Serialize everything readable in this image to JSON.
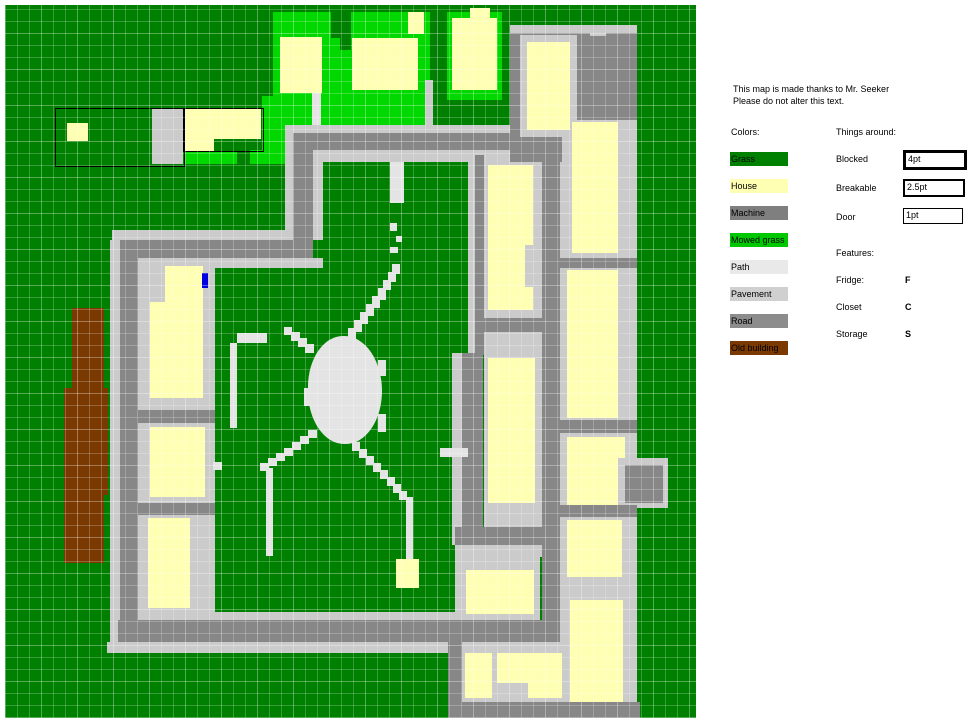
{
  "legend": {
    "credit_line1": "This map is made thanks to Mr. Seeker",
    "credit_line2": "Please do not alter this text.",
    "colors_title": "Colors:",
    "swatches": [
      {
        "label": "Grass",
        "color": "#008000"
      },
      {
        "label": "House",
        "color": "#FFFFB4"
      },
      {
        "label": "Machine",
        "color": "#7F7F7F"
      },
      {
        "label": "Mowed grass",
        "color": "#00C800"
      },
      {
        "label": "Path",
        "color": "#E9E9E9"
      },
      {
        "label": "Pavement",
        "color": "#D0D0D0"
      },
      {
        "label": "Road",
        "color": "#8C8C8C"
      },
      {
        "label": "Old building",
        "color": "#7A3900"
      }
    ],
    "things_title": "Things around:",
    "things": [
      {
        "label": "Blocked",
        "value": "4pt",
        "border_px": 3
      },
      {
        "label": "Breakable",
        "value": "2.5pt",
        "border_px": 2
      },
      {
        "label": "Door",
        "value": "1pt",
        "border_px": 1
      }
    ],
    "features_title": "Features:",
    "features": [
      {
        "label": "Fridge:",
        "value": "F"
      },
      {
        "label": "Closet",
        "value": "C"
      },
      {
        "label": "Storage",
        "value": "S"
      }
    ]
  },
  "map": {
    "bounds": {
      "x": 5,
      "y": 5,
      "w": 691,
      "h": 713
    },
    "palette": {
      "grass": "#008000",
      "mowed": "#00D800",
      "house": "#FFFFB4",
      "path": "#E4E4E4",
      "pavement": "#CBCBCB",
      "road": "#878787",
      "old": "#7A3900",
      "door": "#0000E0"
    },
    "rect_format": "[x, y, w, h, colorKey]",
    "rects": [
      [
        5,
        5,
        691,
        713,
        "grass"
      ],
      [
        273,
        12,
        157,
        113,
        "mowed"
      ],
      [
        331,
        12,
        20,
        26,
        "grass"
      ],
      [
        340,
        26,
        11,
        24,
        "grass"
      ],
      [
        447,
        12,
        55,
        88,
        "mowed"
      ],
      [
        280,
        37,
        42,
        56,
        "house"
      ],
      [
        352,
        38,
        66,
        52,
        "house"
      ],
      [
        408,
        12,
        16,
        22,
        "house"
      ],
      [
        470,
        8,
        20,
        10,
        "house"
      ],
      [
        452,
        18,
        45,
        72,
        "house"
      ],
      [
        312,
        93,
        9,
        41,
        "path"
      ],
      [
        425,
        80,
        8,
        53,
        "pavement"
      ],
      [
        152,
        108,
        31,
        56,
        "pavement"
      ],
      [
        67,
        123,
        21,
        18,
        "house"
      ],
      [
        184,
        109,
        77,
        30,
        "house"
      ],
      [
        185,
        139,
        29,
        12,
        "house"
      ],
      [
        262,
        96,
        24,
        68,
        "mowed"
      ],
      [
        250,
        150,
        12,
        14,
        "mowed"
      ],
      [
        185,
        151,
        52,
        13,
        "mowed"
      ],
      [
        285,
        125,
        226,
        8,
        "pavement"
      ],
      [
        313,
        150,
        198,
        12,
        "pavement"
      ],
      [
        285,
        133,
        226,
        17,
        "road"
      ],
      [
        285,
        125,
        8,
        115,
        "pavement"
      ],
      [
        313,
        162,
        10,
        78,
        "pavement"
      ],
      [
        293,
        150,
        20,
        92,
        "road"
      ],
      [
        112,
        230,
        181,
        10,
        "pavement"
      ],
      [
        138,
        258,
        185,
        10,
        "pavement"
      ],
      [
        120,
        240,
        193,
        18,
        "road"
      ],
      [
        110,
        240,
        10,
        402,
        "pavement"
      ],
      [
        138,
        268,
        10,
        344,
        "pavement"
      ],
      [
        120,
        258,
        18,
        362,
        "road"
      ],
      [
        138,
        612,
        317,
        8,
        "pavement"
      ],
      [
        107,
        642,
        358,
        11,
        "pavement"
      ],
      [
        118,
        620,
        337,
        22,
        "road"
      ],
      [
        148,
        258,
        67,
        354,
        "pavement"
      ],
      [
        135,
        410,
        80,
        13,
        "road"
      ],
      [
        135,
        503,
        80,
        12,
        "road"
      ],
      [
        165,
        266,
        38,
        36,
        "house"
      ],
      [
        150,
        302,
        53,
        96,
        "house"
      ],
      [
        150,
        427,
        55,
        70,
        "house"
      ],
      [
        148,
        518,
        42,
        90,
        "house"
      ],
      [
        202,
        273,
        6,
        15,
        "door"
      ],
      [
        72,
        308,
        32,
        80,
        "old"
      ],
      [
        64,
        388,
        44,
        107,
        "old"
      ],
      [
        64,
        495,
        40,
        68,
        "old"
      ],
      [
        468,
        155,
        7,
        198,
        "pavement"
      ],
      [
        475,
        155,
        9,
        200,
        "road"
      ],
      [
        452,
        353,
        10,
        192,
        "pavement"
      ],
      [
        462,
        353,
        21,
        192,
        "road"
      ],
      [
        455,
        527,
        105,
        18,
        "road"
      ],
      [
        455,
        545,
        100,
        12,
        "pavement"
      ],
      [
        484,
        515,
        60,
        12,
        "pavement"
      ],
      [
        484,
        155,
        60,
        372,
        "pavement"
      ],
      [
        475,
        318,
        70,
        14,
        "road"
      ],
      [
        488,
        165,
        45,
        145,
        "house"
      ],
      [
        525,
        245,
        8,
        42,
        "pavement"
      ],
      [
        488,
        358,
        47,
        145,
        "house"
      ],
      [
        560,
        118,
        77,
        600,
        "pavement"
      ],
      [
        542,
        150,
        18,
        560,
        "road"
      ],
      [
        510,
        25,
        127,
        95,
        "road"
      ],
      [
        510,
        25,
        127,
        8,
        "pavement"
      ],
      [
        590,
        25,
        16,
        11,
        "pavement"
      ],
      [
        510,
        120,
        52,
        42,
        "road"
      ],
      [
        520,
        35,
        57,
        102,
        "pavement"
      ],
      [
        527,
        42,
        43,
        88,
        "house"
      ],
      [
        572,
        122,
        46,
        131,
        "house"
      ],
      [
        555,
        258,
        82,
        10,
        "road"
      ],
      [
        567,
        270,
        51,
        148,
        "house"
      ],
      [
        555,
        420,
        82,
        13,
        "road"
      ],
      [
        567,
        437,
        58,
        68,
        "house"
      ],
      [
        618,
        458,
        50,
        50,
        "pavement"
      ],
      [
        625,
        465,
        38,
        38,
        "road"
      ],
      [
        555,
        505,
        82,
        12,
        "road"
      ],
      [
        567,
        520,
        55,
        57,
        "house"
      ],
      [
        570,
        600,
        53,
        103,
        "house"
      ],
      [
        455,
        545,
        85,
        77,
        "pavement"
      ],
      [
        466,
        570,
        68,
        44,
        "house"
      ],
      [
        448,
        620,
        112,
        22,
        "road"
      ],
      [
        448,
        642,
        14,
        76,
        "road"
      ],
      [
        462,
        642,
        98,
        60,
        "pavement"
      ],
      [
        465,
        653,
        27,
        45,
        "house"
      ],
      [
        497,
        653,
        65,
        30,
        "house"
      ],
      [
        528,
        683,
        34,
        15,
        "house"
      ],
      [
        448,
        702,
        192,
        16,
        "road"
      ],
      [
        390,
        162,
        14,
        41,
        "path"
      ],
      [
        390,
        223,
        7,
        8,
        "path"
      ],
      [
        396,
        236,
        6,
        6,
        "path"
      ],
      [
        390,
        247,
        8,
        6,
        "path"
      ],
      [
        237,
        333,
        30,
        10,
        "path"
      ],
      [
        230,
        343,
        7,
        85,
        "path"
      ],
      [
        213,
        462,
        9,
        8,
        "path"
      ],
      [
        266,
        468,
        7,
        88,
        "path"
      ],
      [
        440,
        448,
        28,
        9,
        "path"
      ],
      [
        406,
        497,
        7,
        62,
        "path"
      ],
      [
        396,
        559,
        23,
        29,
        "house"
      ],
      [
        348,
        328,
        8,
        12,
        "path"
      ],
      [
        354,
        320,
        8,
        12,
        "path"
      ],
      [
        360,
        312,
        8,
        12,
        "path"
      ],
      [
        366,
        304,
        8,
        12,
        "path"
      ],
      [
        372,
        296,
        8,
        12,
        "path"
      ],
      [
        378,
        288,
        8,
        12,
        "path"
      ],
      [
        383,
        280,
        8,
        10,
        "path"
      ],
      [
        388,
        272,
        8,
        10,
        "path"
      ],
      [
        392,
        264,
        8,
        10,
        "path"
      ],
      [
        305,
        344,
        9,
        9,
        "path"
      ],
      [
        298,
        338,
        9,
        9,
        "path"
      ],
      [
        291,
        332,
        9,
        9,
        "path"
      ],
      [
        284,
        327,
        8,
        8,
        "path"
      ],
      [
        308,
        430,
        9,
        8,
        "path"
      ],
      [
        300,
        436,
        9,
        8,
        "path"
      ],
      [
        292,
        442,
        9,
        8,
        "path"
      ],
      [
        284,
        448,
        9,
        8,
        "path"
      ],
      [
        276,
        453,
        9,
        8,
        "path"
      ],
      [
        268,
        458,
        9,
        8,
        "path"
      ],
      [
        260,
        463,
        9,
        8,
        "path"
      ],
      [
        352,
        442,
        8,
        9,
        "path"
      ],
      [
        359,
        449,
        8,
        9,
        "path"
      ],
      [
        366,
        456,
        8,
        9,
        "path"
      ],
      [
        373,
        463,
        8,
        9,
        "path"
      ],
      [
        380,
        470,
        8,
        9,
        "path"
      ],
      [
        387,
        477,
        8,
        9,
        "path"
      ],
      [
        393,
        484,
        8,
        9,
        "path"
      ],
      [
        399,
        491,
        8,
        9,
        "path"
      ],
      [
        304,
        388,
        8,
        18,
        "path"
      ],
      [
        378,
        360,
        8,
        16,
        "path"
      ],
      [
        378,
        414,
        8,
        18,
        "path"
      ]
    ],
    "blob": {
      "x": 308,
      "y": 336,
      "w": 74,
      "h": 108,
      "colorKey": "path"
    },
    "outlined_plots": [
      {
        "x": 55,
        "y": 108,
        "w": 128,
        "h": 57
      },
      {
        "x": 183,
        "y": 108,
        "w": 79,
        "h": 42
      }
    ]
  }
}
